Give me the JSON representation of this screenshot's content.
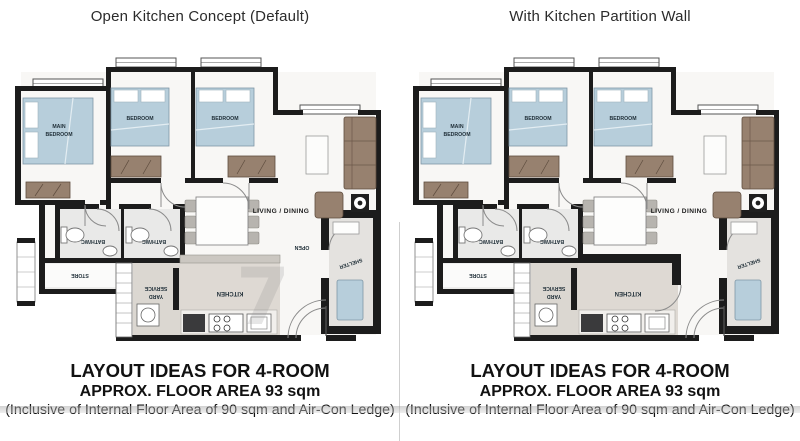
{
  "titles": {
    "left": "Open Kitchen Concept (Default)",
    "right": "With Kitchen Partition Wall"
  },
  "caption": {
    "line1": "LAYOUT IDEAS FOR 4-ROOM",
    "line2": "APPROX. FLOOR AREA 93 sqm",
    "line3": "(Inclusive of Internal Floor Area of 90 sqm and Air-Con Ledge)"
  },
  "rooms": {
    "main_bedroom_line1": "MAIN",
    "main_bedroom_line2": "BEDROOM",
    "bedroom2": "BEDROOM",
    "bedroom3": "BEDROOM",
    "living_dining": "LIVING / DINING",
    "bath1": "BATH/WC",
    "bath2": "BATH/WC",
    "store": "STORE",
    "service_yard_line1": "SERVICE",
    "service_yard_line2": "YARD",
    "kitchen": "KITCHEN",
    "shelter": "SHELTER",
    "open_label": "OPEN"
  },
  "extras": {
    "watermark": "7"
  },
  "colors": {
    "wall": "#1c1c1c",
    "bed_blue": "#b7cedb",
    "furniture_wood": "#97816f",
    "kitchen_floor": "#ded9d3",
    "yard_floor": "#dbd7d1"
  }
}
